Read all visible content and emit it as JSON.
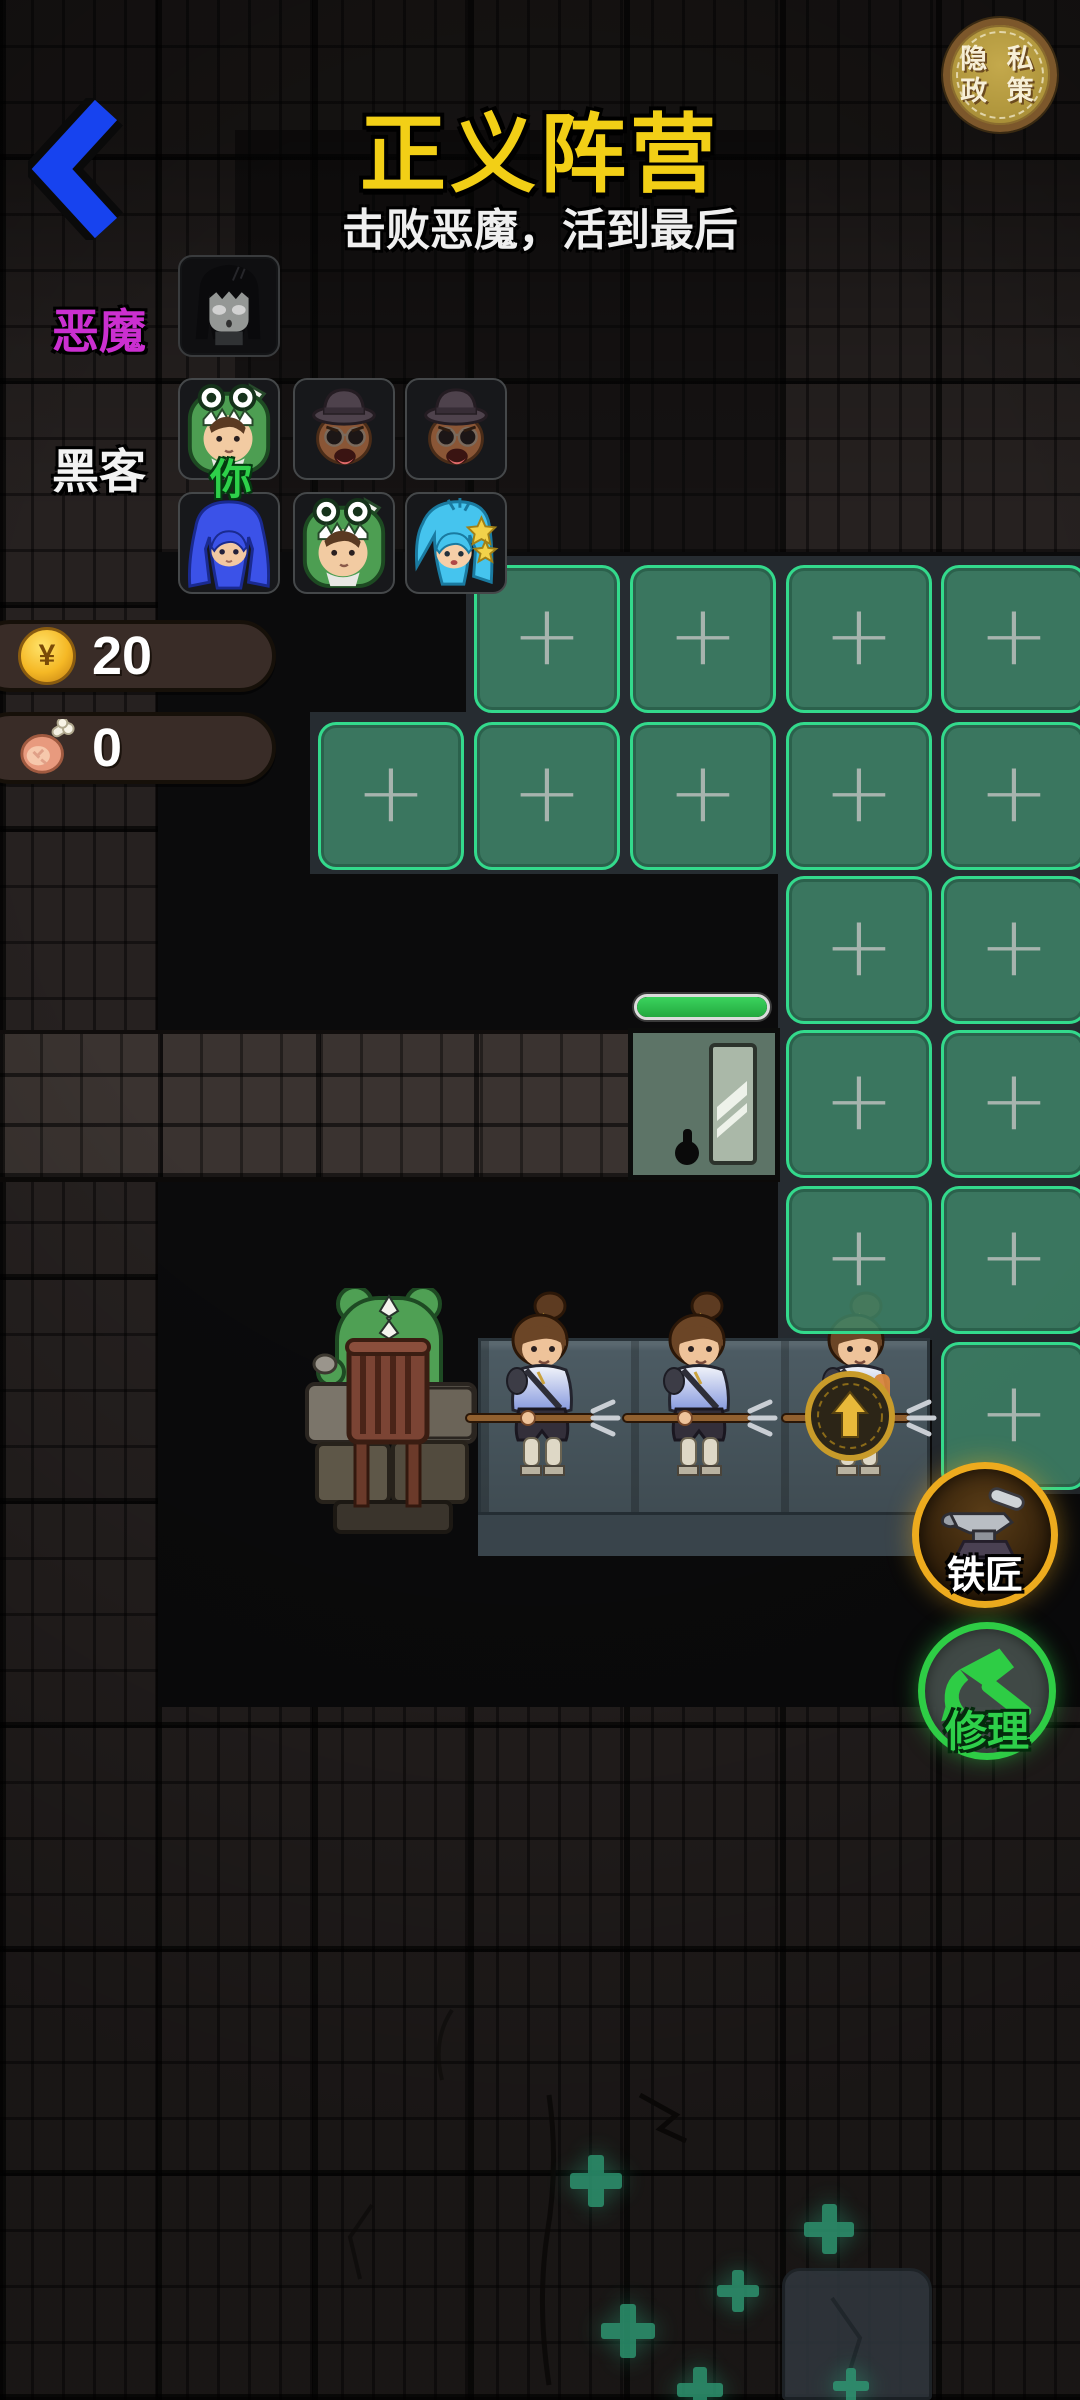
{
  "header": {
    "title": "正义阵营",
    "subtitle": "击败恶魔，活到最后",
    "privacy_button": {
      "line1": "隐 私",
      "line2": "政 策"
    }
  },
  "teams": {
    "demon": {
      "label": "恶魔",
      "members": [
        {
          "avatar": "dark-ghost-girl"
        }
      ]
    },
    "hacker": {
      "label": "黑客",
      "you_badge": "你",
      "members_row1": [
        {
          "avatar": "frog-hood-girl",
          "you": true
        },
        {
          "avatar": "top-hat-shades-man"
        },
        {
          "avatar": "top-hat-shades-man"
        }
      ],
      "members_row2": [
        {
          "avatar": "blue-twintail-girl"
        },
        {
          "avatar": "frog-hood-girl"
        },
        {
          "avatar": "cyan-star-girl"
        }
      ]
    }
  },
  "resources": {
    "gold": "20",
    "food": "0",
    "coin_symbol": "¥"
  },
  "board": {
    "plus_glyph": "+",
    "empty_slots": [
      {
        "row": 1,
        "col": 2
      },
      {
        "row": 1,
        "col": 3
      },
      {
        "row": 1,
        "col": 4
      },
      {
        "row": 1,
        "col": 5
      },
      {
        "row": 2,
        "col": 1
      },
      {
        "row": 2,
        "col": 2
      },
      {
        "row": 2,
        "col": 3
      },
      {
        "row": 2,
        "col": 4
      },
      {
        "row": 2,
        "col": 5
      },
      {
        "row": 3,
        "col": 4
      },
      {
        "row": 3,
        "col": 5
      },
      {
        "row": 4,
        "col": 4
      },
      {
        "row": 4,
        "col": 5
      },
      {
        "row": 5,
        "col": 4
      },
      {
        "row": 5,
        "col": 5
      },
      {
        "row": 6,
        "col": 5
      }
    ],
    "gate": {
      "health_percent": 100
    }
  },
  "units": {
    "boss": "frog-chief-on-chair",
    "soldiers": [
      "spearman",
      "spearman",
      "spearman-with-shield"
    ]
  },
  "buttons": {
    "blacksmith": "铁匠",
    "repair": "修理"
  },
  "decor": {
    "plus_marks": [
      {
        "x": 596,
        "y": 2181,
        "s": 52
      },
      {
        "x": 829,
        "y": 2229,
        "s": 50
      },
      {
        "x": 738,
        "y": 2291,
        "s": 42
      },
      {
        "x": 628,
        "y": 2331,
        "s": 54
      },
      {
        "x": 700,
        "y": 2390,
        "s": 46
      },
      {
        "x": 851,
        "y": 2386,
        "s": 36
      }
    ]
  },
  "colors": {
    "accent_green": "#33da8c",
    "accent_gold": "#edab1e",
    "repair_green": "#2ecd45",
    "title_yellow": "#f2cf16",
    "demon_magenta": "#cb2fd0",
    "back_blue": "#1743ef"
  }
}
